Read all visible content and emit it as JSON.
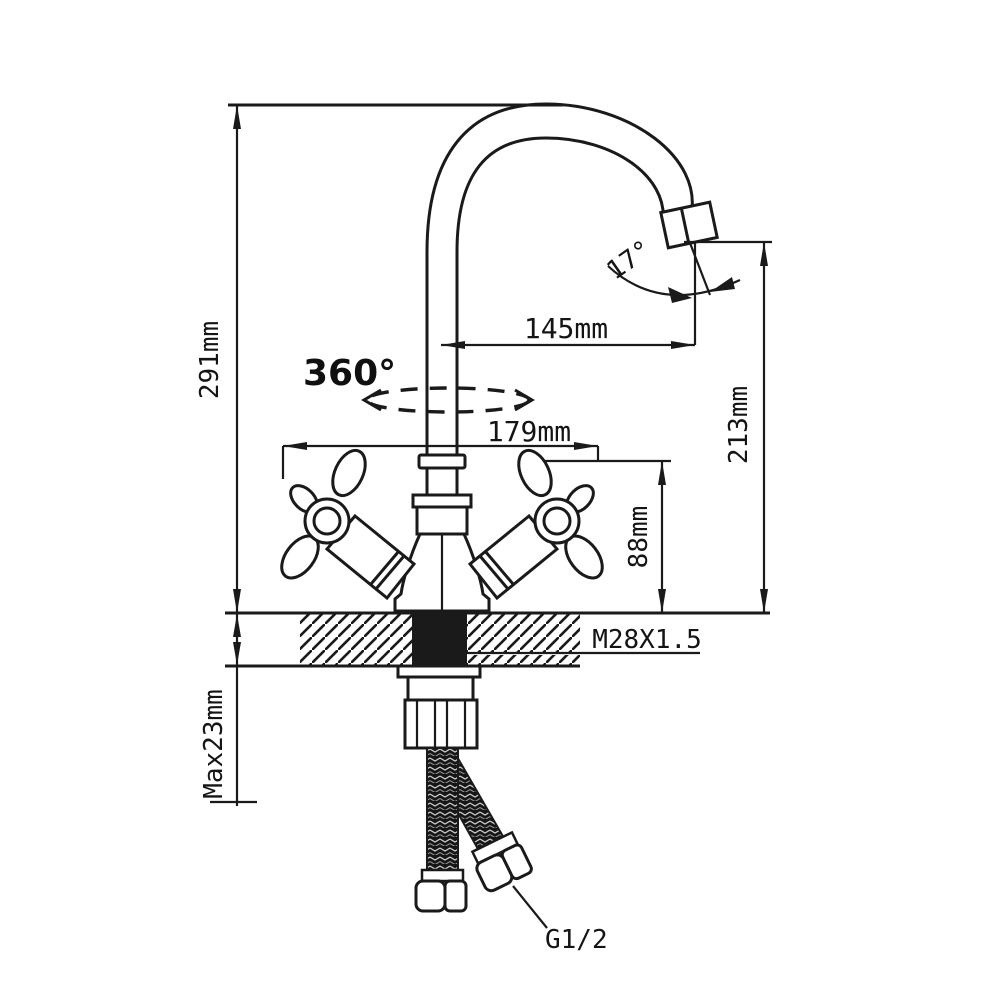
{
  "drawing": {
    "title": "kitchen-faucet-dimension-drawing",
    "colors": {
      "ink": "#1a1a1a",
      "background": "#ffffff"
    },
    "labels": {
      "overall_height": "291mm",
      "spout_reach": "145mm",
      "spout_angle": "17°",
      "swivel_rotation": "360°",
      "handle_span": "179mm",
      "spout_height": "213mm",
      "body_height": "88mm",
      "mount_thread": "M28X1.5",
      "max_deck_thickness": "Max23mm",
      "hose_thread": "G1/2"
    }
  }
}
